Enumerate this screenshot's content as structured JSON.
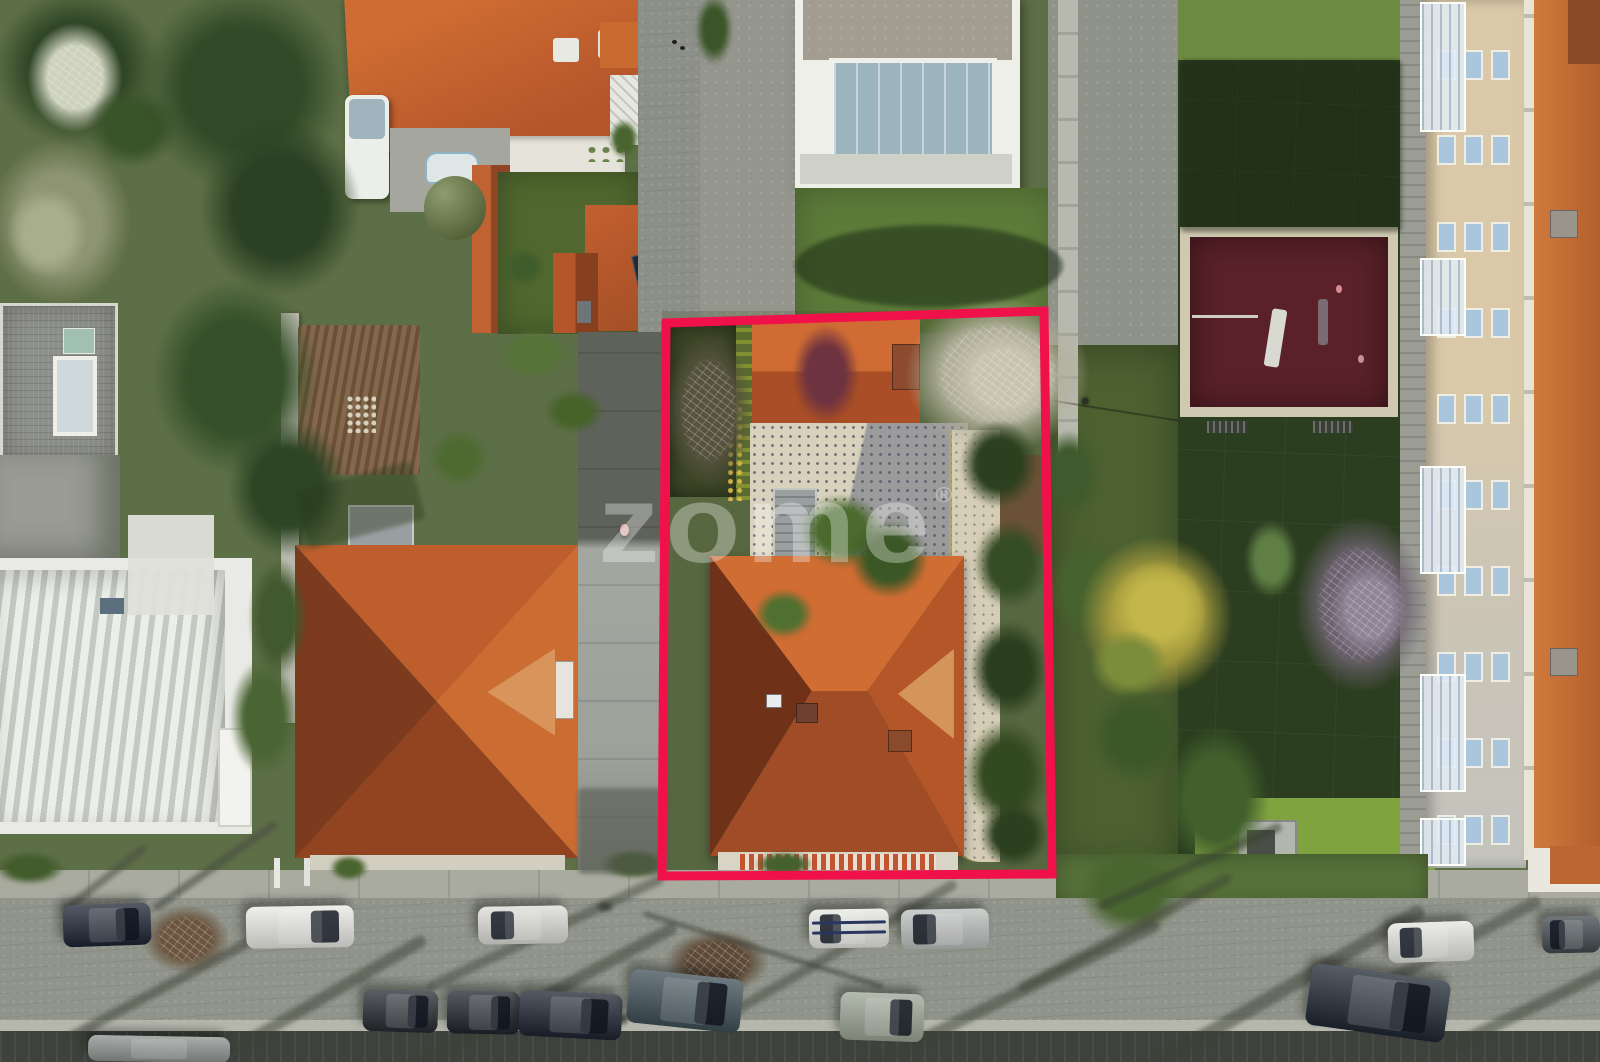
{
  "meta": {
    "description": "Aerial drone photograph of a residential block; one property lot is highlighted with a red boundary outline; real-estate watermark in the centre",
    "scene_type": "real-estate-aerial-photo"
  },
  "watermark": {
    "text": "zome",
    "registered": "®",
    "color": "#ffffff",
    "opacity": 0.32,
    "font_size_px": 110,
    "x": 598,
    "y": 470
  },
  "outline": {
    "color": "#F0114B",
    "points": "666,323 1044,311 1052,874 662,876",
    "stroke_width": 9
  },
  "palette": {
    "outline": "#F0114B",
    "terracotta-bright": "#c96a31",
    "terracotta-mid": "#a84f28",
    "terracotta-dark": "#7c3a1e",
    "street": "#90948a",
    "sidewalk": "#a9ab9f",
    "lawn-dark": "#2c3e20",
    "lawn-bright": "#7fa33f",
    "playground": "#5a2128",
    "playground-border": "#cfc9b2",
    "facade-cream": "#d9c9a8",
    "patio-cream": "#d8d1bd",
    "window-blue": "#a9c6dd"
  },
  "apartment": {
    "window_col_xs": [
      1437,
      1464,
      1491
    ],
    "window_row_ys": [
      50,
      135,
      222,
      308,
      394,
      480,
      566,
      652,
      738,
      815
    ],
    "window_w": 15,
    "window_h": 26,
    "balconies": [
      {
        "y": 2,
        "h": 126
      },
      {
        "y": 258,
        "h": 74
      },
      {
        "y": 466,
        "h": 104
      },
      {
        "y": 674,
        "h": 114
      },
      {
        "y": 818,
        "h": 44
      }
    ]
  },
  "cars": [
    {
      "x": 63,
      "y": 904,
      "w": 88,
      "h": 42,
      "rot": -2,
      "color": "#1c2433",
      "glass": "right"
    },
    {
      "x": 246,
      "y": 906,
      "w": 108,
      "h": 42,
      "rot": -1,
      "color": "#e9eae5",
      "glass": "right"
    },
    {
      "x": 478,
      "y": 906,
      "w": 90,
      "h": 38,
      "rot": -1,
      "color": "#dcddd7",
      "glass": "left"
    },
    {
      "x": 809,
      "y": 909,
      "w": 80,
      "h": 39,
      "rot": -1,
      "color": "#e7e8e3",
      "glass": "left",
      "stripes": true
    },
    {
      "x": 901,
      "y": 909,
      "w": 88,
      "h": 40,
      "rot": -1,
      "color": "#bcbfbd",
      "glass": "left"
    },
    {
      "x": 1388,
      "y": 922,
      "w": 86,
      "h": 40,
      "rot": -2,
      "color": "#e4e5e0",
      "glass": "left"
    },
    {
      "x": 1542,
      "y": 916,
      "w": 58,
      "h": 37,
      "rot": -1,
      "color": "#41494e",
      "glass": "left"
    },
    {
      "x": 363,
      "y": 990,
      "w": 75,
      "h": 42,
      "rot": 2,
      "color": "#262b31",
      "glass": "right"
    },
    {
      "x": 447,
      "y": 991,
      "w": 73,
      "h": 43,
      "rot": 1,
      "color": "#20252c",
      "glass": "right"
    },
    {
      "x": 519,
      "y": 992,
      "w": 103,
      "h": 46,
      "rot": 3,
      "color": "#1d2330",
      "glass": "right"
    },
    {
      "x": 628,
      "y": 974,
      "w": 114,
      "h": 54,
      "rot": 6,
      "color": "#3e4e56",
      "glass": "right"
    },
    {
      "x": 840,
      "y": 993,
      "w": 84,
      "h": 48,
      "rot": 2,
      "color": "#9ba494",
      "glass": "right"
    },
    {
      "x": 1308,
      "y": 972,
      "w": 140,
      "h": 62,
      "rot": 8,
      "color": "#1f2732",
      "glass": "right"
    },
    {
      "x": 88,
      "y": 1036,
      "w": 142,
      "h": 26,
      "rot": 1,
      "color": "#8d9290",
      "glass": "none"
    }
  ],
  "vegetation": [
    {
      "x": -10,
      "y": -15,
      "w": 175,
      "h": 165,
      "c": "#2f4526",
      "t": "soft"
    },
    {
      "x": 25,
      "y": 20,
      "w": 100,
      "h": 115,
      "c": "#cdd1bd",
      "t": "bare"
    },
    {
      "x": 85,
      "y": 85,
      "w": 95,
      "h": 85,
      "c": "#3a5429",
      "t": "soft"
    },
    {
      "x": -15,
      "y": 135,
      "w": 150,
      "h": 175,
      "c": "#8e9472",
      "t": "soft"
    },
    {
      "x": 5,
      "y": 185,
      "w": 85,
      "h": 95,
      "c": "#a8ad8c",
      "t": "soft"
    },
    {
      "x": 135,
      "y": -20,
      "w": 215,
      "h": 215,
      "c": "#324a28",
      "t": "soft"
    },
    {
      "x": 195,
      "y": 115,
      "w": 170,
      "h": 185,
      "c": "#2c4124",
      "t": "soft"
    },
    {
      "x": 148,
      "y": 275,
      "w": 175,
      "h": 205,
      "c": "#35502a",
      "t": "soft"
    },
    {
      "x": 225,
      "y": 415,
      "w": 125,
      "h": 145,
      "c": "#2e4525",
      "t": "soft"
    },
    {
      "x": 247,
      "y": 555,
      "w": 62,
      "h": 125,
      "c": "#42582e",
      "t": "soft"
    },
    {
      "x": 228,
      "y": 655,
      "w": 72,
      "h": 125,
      "c": "#4a6433",
      "t": "soft"
    },
    {
      "x": 428,
      "y": 428,
      "w": 62,
      "h": 60,
      "c": "#4e6a31",
      "t": "soft"
    },
    {
      "x": 498,
      "y": 328,
      "w": 72,
      "h": 52,
      "c": "#567538",
      "t": "soft"
    },
    {
      "x": 543,
      "y": 388,
      "w": 62,
      "h": 47,
      "c": "#476329",
      "t": "soft"
    },
    {
      "x": 424,
      "y": 176,
      "w": 62,
      "h": 64,
      "c": "#6d7f46",
      "t": "round"
    },
    {
      "x": 503,
      "y": 248,
      "w": 42,
      "h": 38,
      "c": "#3f5c2b",
      "t": "soft"
    },
    {
      "x": 608,
      "y": 118,
      "w": 32,
      "h": 42,
      "c": "#49642f",
      "t": "soft"
    },
    {
      "x": 694,
      "y": -8,
      "w": 40,
      "h": 75,
      "c": "#3c5528",
      "t": "soft"
    },
    {
      "x": 791,
      "y": 322,
      "w": 70,
      "h": 104,
      "c": "#6e3340",
      "t": "soft"
    },
    {
      "x": 663,
      "y": 328,
      "w": 92,
      "h": 165,
      "c": "#55523d",
      "t": "bare"
    },
    {
      "x": 798,
      "y": 492,
      "w": 88,
      "h": 78,
      "c": "#4a6a2e",
      "t": "soft"
    },
    {
      "x": 848,
      "y": 518,
      "w": 82,
      "h": 82,
      "c": "#3c5726",
      "t": "soft"
    },
    {
      "x": 753,
      "y": 588,
      "w": 62,
      "h": 52,
      "c": "#507031",
      "t": "soft"
    },
    {
      "x": 900,
      "y": 292,
      "w": 195,
      "h": 165,
      "c": "#b2b09b",
      "t": "bare"
    },
    {
      "x": 948,
      "y": 328,
      "w": 112,
      "h": 102,
      "c": "#c6c4ae",
      "t": "bare"
    },
    {
      "x": 958,
      "y": 418,
      "w": 82,
      "h": 92,
      "c": "#2c401f",
      "t": "soft"
    },
    {
      "x": 972,
      "y": 518,
      "w": 77,
      "h": 92,
      "c": "#354c25",
      "t": "soft"
    },
    {
      "x": 968,
      "y": 618,
      "w": 82,
      "h": 102,
      "c": "#2a3e1e",
      "t": "soft"
    },
    {
      "x": 963,
      "y": 718,
      "w": 87,
      "h": 112,
      "c": "#33491f",
      "t": "soft"
    },
    {
      "x": 978,
      "y": 798,
      "w": 72,
      "h": 72,
      "c": "#2c401f",
      "t": "soft"
    },
    {
      "x": 1038,
      "y": 428,
      "w": 62,
      "h": 92,
      "c": "#3f5a2c",
      "t": "soft"
    },
    {
      "x": 1048,
      "y": 538,
      "w": 72,
      "h": 102,
      "c": "#46622e",
      "t": "soft"
    },
    {
      "x": 1075,
      "y": 532,
      "w": 162,
      "h": 168,
      "c": "#a59b3e",
      "t": "soft"
    },
    {
      "x": 1108,
      "y": 558,
      "w": 102,
      "h": 102,
      "c": "#c2b64a",
      "t": "soft"
    },
    {
      "x": 1088,
      "y": 628,
      "w": 82,
      "h": 72,
      "c": "#7b8c3a",
      "t": "soft"
    },
    {
      "x": 1088,
      "y": 688,
      "w": 97,
      "h": 97,
      "c": "#3d5828",
      "t": "soft"
    },
    {
      "x": 1292,
      "y": 512,
      "w": 138,
      "h": 185,
      "c": "#6d6270",
      "t": "bare"
    },
    {
      "x": 1328,
      "y": 558,
      "w": 82,
      "h": 102,
      "c": "#8d8496",
      "t": "bare"
    },
    {
      "x": 1243,
      "y": 518,
      "w": 56,
      "h": 82,
      "c": "#5f7f45",
      "t": "soft"
    },
    {
      "x": 1160,
      "y": 722,
      "w": 112,
      "h": 152,
      "c": "#42602c",
      "t": "soft"
    },
    {
      "x": 1075,
      "y": 842,
      "w": 112,
      "h": 97,
      "c": "#4a6630",
      "t": "soft"
    },
    {
      "x": -8,
      "y": 850,
      "w": 75,
      "h": 36,
      "c": "#435c2c",
      "t": "soft"
    },
    {
      "x": 328,
      "y": 854,
      "w": 42,
      "h": 28,
      "c": "#49632e",
      "t": "soft"
    },
    {
      "x": 598,
      "y": 848,
      "w": 72,
      "h": 32,
      "c": "#3f5a2a",
      "t": "soft"
    },
    {
      "x": 753,
      "y": 850,
      "w": 62,
      "h": 28,
      "c": "#46612d",
      "t": "soft"
    },
    {
      "x": 140,
      "y": 903,
      "w": 92,
      "h": 72,
      "c": "#6b553f",
      "t": "bare"
    },
    {
      "x": 662,
      "y": 928,
      "w": 110,
      "h": 68,
      "c": "#5e4a37",
      "t": "bare"
    }
  ],
  "shadows": [
    {
      "x": 55,
      "y": 975,
      "w": 245,
      "h": 10,
      "rot": -28,
      "c": "#3c4035",
      "o": 0.5
    },
    {
      "x": 145,
      "y": 1008,
      "w": 300,
      "h": 12,
      "rot": -30,
      "c": "#3c4035",
      "o": 0.5
    },
    {
      "x": 415,
      "y": 928,
      "w": 260,
      "h": 10,
      "rot": -25,
      "c": "#3c4035",
      "o": 0.45
    },
    {
      "x": 365,
      "y": 998,
      "w": 330,
      "h": 12,
      "rot": -28,
      "c": "#3c4035",
      "o": 0.5
    },
    {
      "x": 695,
      "y": 948,
      "w": 280,
      "h": 10,
      "rot": -30,
      "c": "#3c4035",
      "o": 0.45
    },
    {
      "x": 855,
      "y": 988,
      "w": 320,
      "h": 12,
      "rot": -26,
      "c": "#3c4035",
      "o": 0.5
    },
    {
      "x": 1005,
      "y": 928,
      "w": 240,
      "h": 10,
      "rot": -28,
      "c": "#3c4035",
      "o": 0.45
    },
    {
      "x": 1115,
      "y": 985,
      "w": 330,
      "h": 14,
      "rot": -30,
      "c": "#3c4035",
      "o": 0.5
    },
    {
      "x": 1295,
      "y": 955,
      "w": 260,
      "h": 12,
      "rot": -28,
      "c": "#3c4035",
      "o": 0.45
    },
    {
      "x": 1425,
      "y": 995,
      "w": 240,
      "h": 12,
      "rot": -26,
      "c": "#3c4035",
      "o": 0.5
    },
    {
      "x": 638,
      "y": 948,
      "w": 250,
      "h": 4,
      "rot": 17,
      "c": "#2f332b",
      "o": 0.6
    },
    {
      "x": 140,
      "y": 862,
      "w": 150,
      "h": 8,
      "rot": -35,
      "c": "#4a4d44",
      "o": 0.6
    },
    {
      "x": 52,
      "y": 875,
      "w": 105,
      "h": 8,
      "rot": -38,
      "c": "#4a4d44",
      "o": 0.55
    },
    {
      "x": 1090,
      "y": 862,
      "w": 200,
      "h": 9,
      "rot": -24,
      "c": "#3a4431",
      "o": 0.55
    },
    {
      "x": 795,
      "y": 225,
      "w": 268,
      "h": 82,
      "rot": 0,
      "c": "#1c2a14",
      "o": 0.55,
      "round": true
    },
    {
      "x": 578,
      "y": 788,
      "w": 90,
      "h": 86,
      "rot": 0,
      "c": "#565a50",
      "o": 0.6
    },
    {
      "x": 598,
      "y": 902,
      "w": 14,
      "h": 9,
      "rot": 0,
      "c": "#3a3d36",
      "o": 0.8
    },
    {
      "x": 612,
      "y": 1014,
      "w": 16,
      "h": 10,
      "rot": 0,
      "c": "#3a3d36",
      "o": 0.8
    },
    {
      "x": 1180,
      "y": 60,
      "w": 222,
      "h": 172,
      "rot": 0,
      "c": "#18230f",
      "o": 0.45
    },
    {
      "x": 300,
      "y": 475,
      "w": 120,
      "h": 60,
      "rot": -15,
      "c": "#2b3a1d",
      "o": 0.4
    }
  ]
}
